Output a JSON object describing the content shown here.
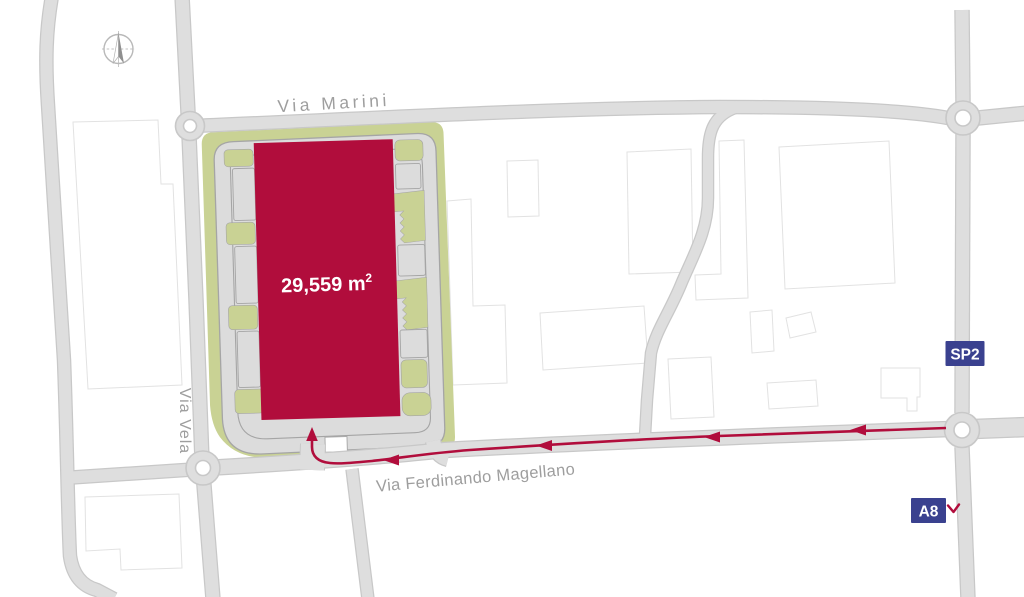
{
  "site": {
    "area_value": "29,559 m",
    "area_superscript": "2"
  },
  "road_labels": {
    "marini": "Via Marini",
    "vela": "Via Vela",
    "magellano": "Via Ferdinando Magellano"
  },
  "badges": {
    "sp2": "SP2",
    "a8": "A8"
  },
  "colors": {
    "building": "#b10d3c",
    "route": "#b10d3c",
    "landscape": "#c9d294",
    "road_fill": "#dedede",
    "road_casing": "#c8c8c8",
    "site_outline": "#a5a5a5",
    "building_outline": "#e2e2e2",
    "badge_navy": "#3a418f",
    "label_gray": "#9e9e9e"
  }
}
